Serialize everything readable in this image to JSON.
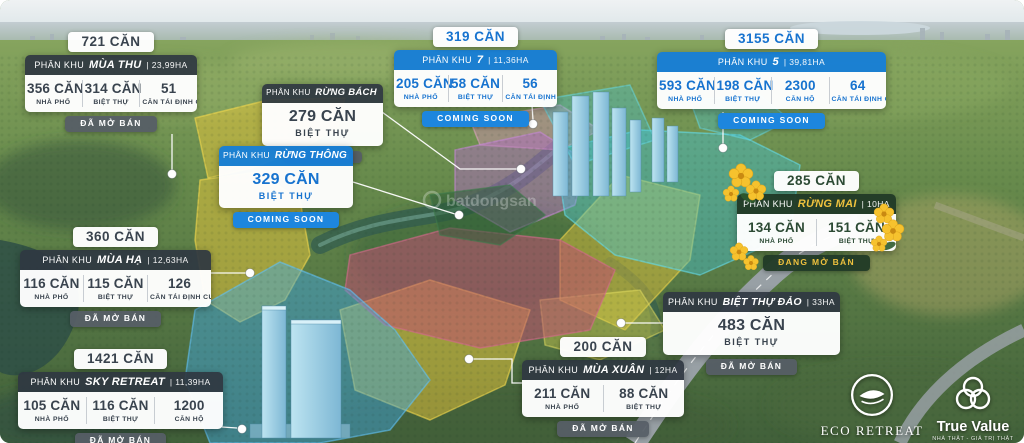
{
  "map": {
    "watermark": "batdongsan",
    "zone_colors": {
      "yellow": "#ecc83a",
      "magenta": "#c14f72",
      "purple": "#b06dc2",
      "teal": "#43c4d6",
      "blue": "#3fa9e8",
      "dark_green": "#2d5e38"
    },
    "accent_navy": "#2f3842",
    "accent_blue": "#177ed6",
    "accent_green": "#213a27",
    "accent_gold": "#eec13e"
  },
  "cards": [
    {
      "id": "mua-thu",
      "total": "721 CĂN",
      "prefix": "PHÂN KHU",
      "name": "MÙA THU",
      "area": "| 23,99HA",
      "stats": [
        {
          "value": "356 CĂN",
          "label": "NHÀ PHỐ"
        },
        {
          "value": "314 CĂN",
          "label": "BIỆT THỰ"
        },
        {
          "value": "51",
          "label": "CĂN TÁI ĐỊNH CƯ"
        }
      ],
      "status": "ĐÃ MỞ BÁN"
    },
    {
      "id": "rung-bach",
      "prefix": "PHÂN KHU",
      "name": "RỪNG BÁCH",
      "area": "",
      "stats": [
        {
          "value": "279 CĂN",
          "label": "BIỆT THỰ"
        }
      ],
      "status": "ĐÃ MỞ BÁN"
    },
    {
      "id": "rung-thong",
      "prefix": "PHÂN KHU",
      "name": "RỪNG THÔNG",
      "area": "",
      "stats": [
        {
          "value": "329 CĂN",
          "label": "BIỆT THỰ"
        }
      ],
      "status": "COMING SOON"
    },
    {
      "id": "phan-khu-7",
      "total": "319 CĂN",
      "prefix": "PHÂN KHU",
      "name": "7",
      "area": "| 11,36HA",
      "stats": [
        {
          "value": "205 CĂN",
          "label": "NHÀ PHỐ"
        },
        {
          "value": "58 CĂN",
          "label": "BIỆT THỰ"
        },
        {
          "value": "56",
          "label": "CĂN TÁI ĐỊNH CƯ"
        }
      ],
      "status": "COMING SOON"
    },
    {
      "id": "phan-khu-5",
      "total": "3155 CĂN",
      "prefix": "PHÂN KHU",
      "name": "5",
      "area": "| 39,81HA",
      "stats": [
        {
          "value": "593 CĂN",
          "label": "NHÀ PHỐ"
        },
        {
          "value": "198 CĂN",
          "label": "BIỆT THỰ"
        },
        {
          "value": "2300",
          "label": "CĂN HỘ"
        },
        {
          "value": "64",
          "label": "CĂN TÁI ĐỊNH CƯ"
        }
      ],
      "status": "COMING SOON"
    },
    {
      "id": "rung-mai",
      "total": "285 CĂN",
      "prefix": "PHÂN KHU",
      "name": "RỪNG MAI",
      "area": "| 10HA",
      "stats": [
        {
          "value": "134 CĂN",
          "label": "NHÀ PHỐ"
        },
        {
          "value": "151 CĂN",
          "label": "BIỆT THỰ"
        }
      ],
      "status": "ĐANG MỞ BÁN"
    },
    {
      "id": "mua-ha",
      "total": "360 CĂN",
      "prefix": "PHÂN KHU",
      "name": "MÙA HẠ",
      "area": "| 12,63HA",
      "stats": [
        {
          "value": "116 CĂN",
          "label": "NHÀ PHỐ"
        },
        {
          "value": "115 CĂN",
          "label": "BIỆT THỰ"
        },
        {
          "value": "126",
          "label": "CĂN TÁI ĐỊNH CƯ"
        }
      ],
      "status": "ĐÃ MỞ BÁN"
    },
    {
      "id": "sky-retreat",
      "total": "1421 CĂN",
      "prefix": "PHÂN KHU",
      "name": "SKY RETREAT",
      "area": "| 11,39HA",
      "stats": [
        {
          "value": "105 CĂN",
          "label": "NHÀ PHỐ"
        },
        {
          "value": "116 CĂN",
          "label": "BIỆT THỰ"
        },
        {
          "value": "1200",
          "label": "CĂN HỘ"
        }
      ],
      "status": "ĐÃ MỞ BÁN"
    },
    {
      "id": "mua-xuan",
      "total": "200 CĂN",
      "prefix": "PHÂN KHU",
      "name": "MÙA XUÂN",
      "area": "| 12HA",
      "stats": [
        {
          "value": "211 CĂN",
          "label": "NHÀ PHỐ"
        },
        {
          "value": "88 CĂN",
          "label": "BIỆT THỰ"
        }
      ],
      "status": "ĐÃ MỞ BÁN"
    },
    {
      "id": "biet-thu-dao",
      "prefix": "PHÂN KHU",
      "name": "BIỆT THỰ ĐẢO",
      "area": "| 33HA",
      "stats": [
        {
          "value": "483 CĂN",
          "label": "BIỆT THỰ"
        }
      ],
      "status": "ĐÃ MỞ BÁN"
    }
  ],
  "logos": {
    "eco_retreat": {
      "name": "ECO RETREAT"
    },
    "true_value": {
      "name": "True Value",
      "tagline": "NHÀ THẬT - GIÁ TRỊ THẬT"
    }
  }
}
